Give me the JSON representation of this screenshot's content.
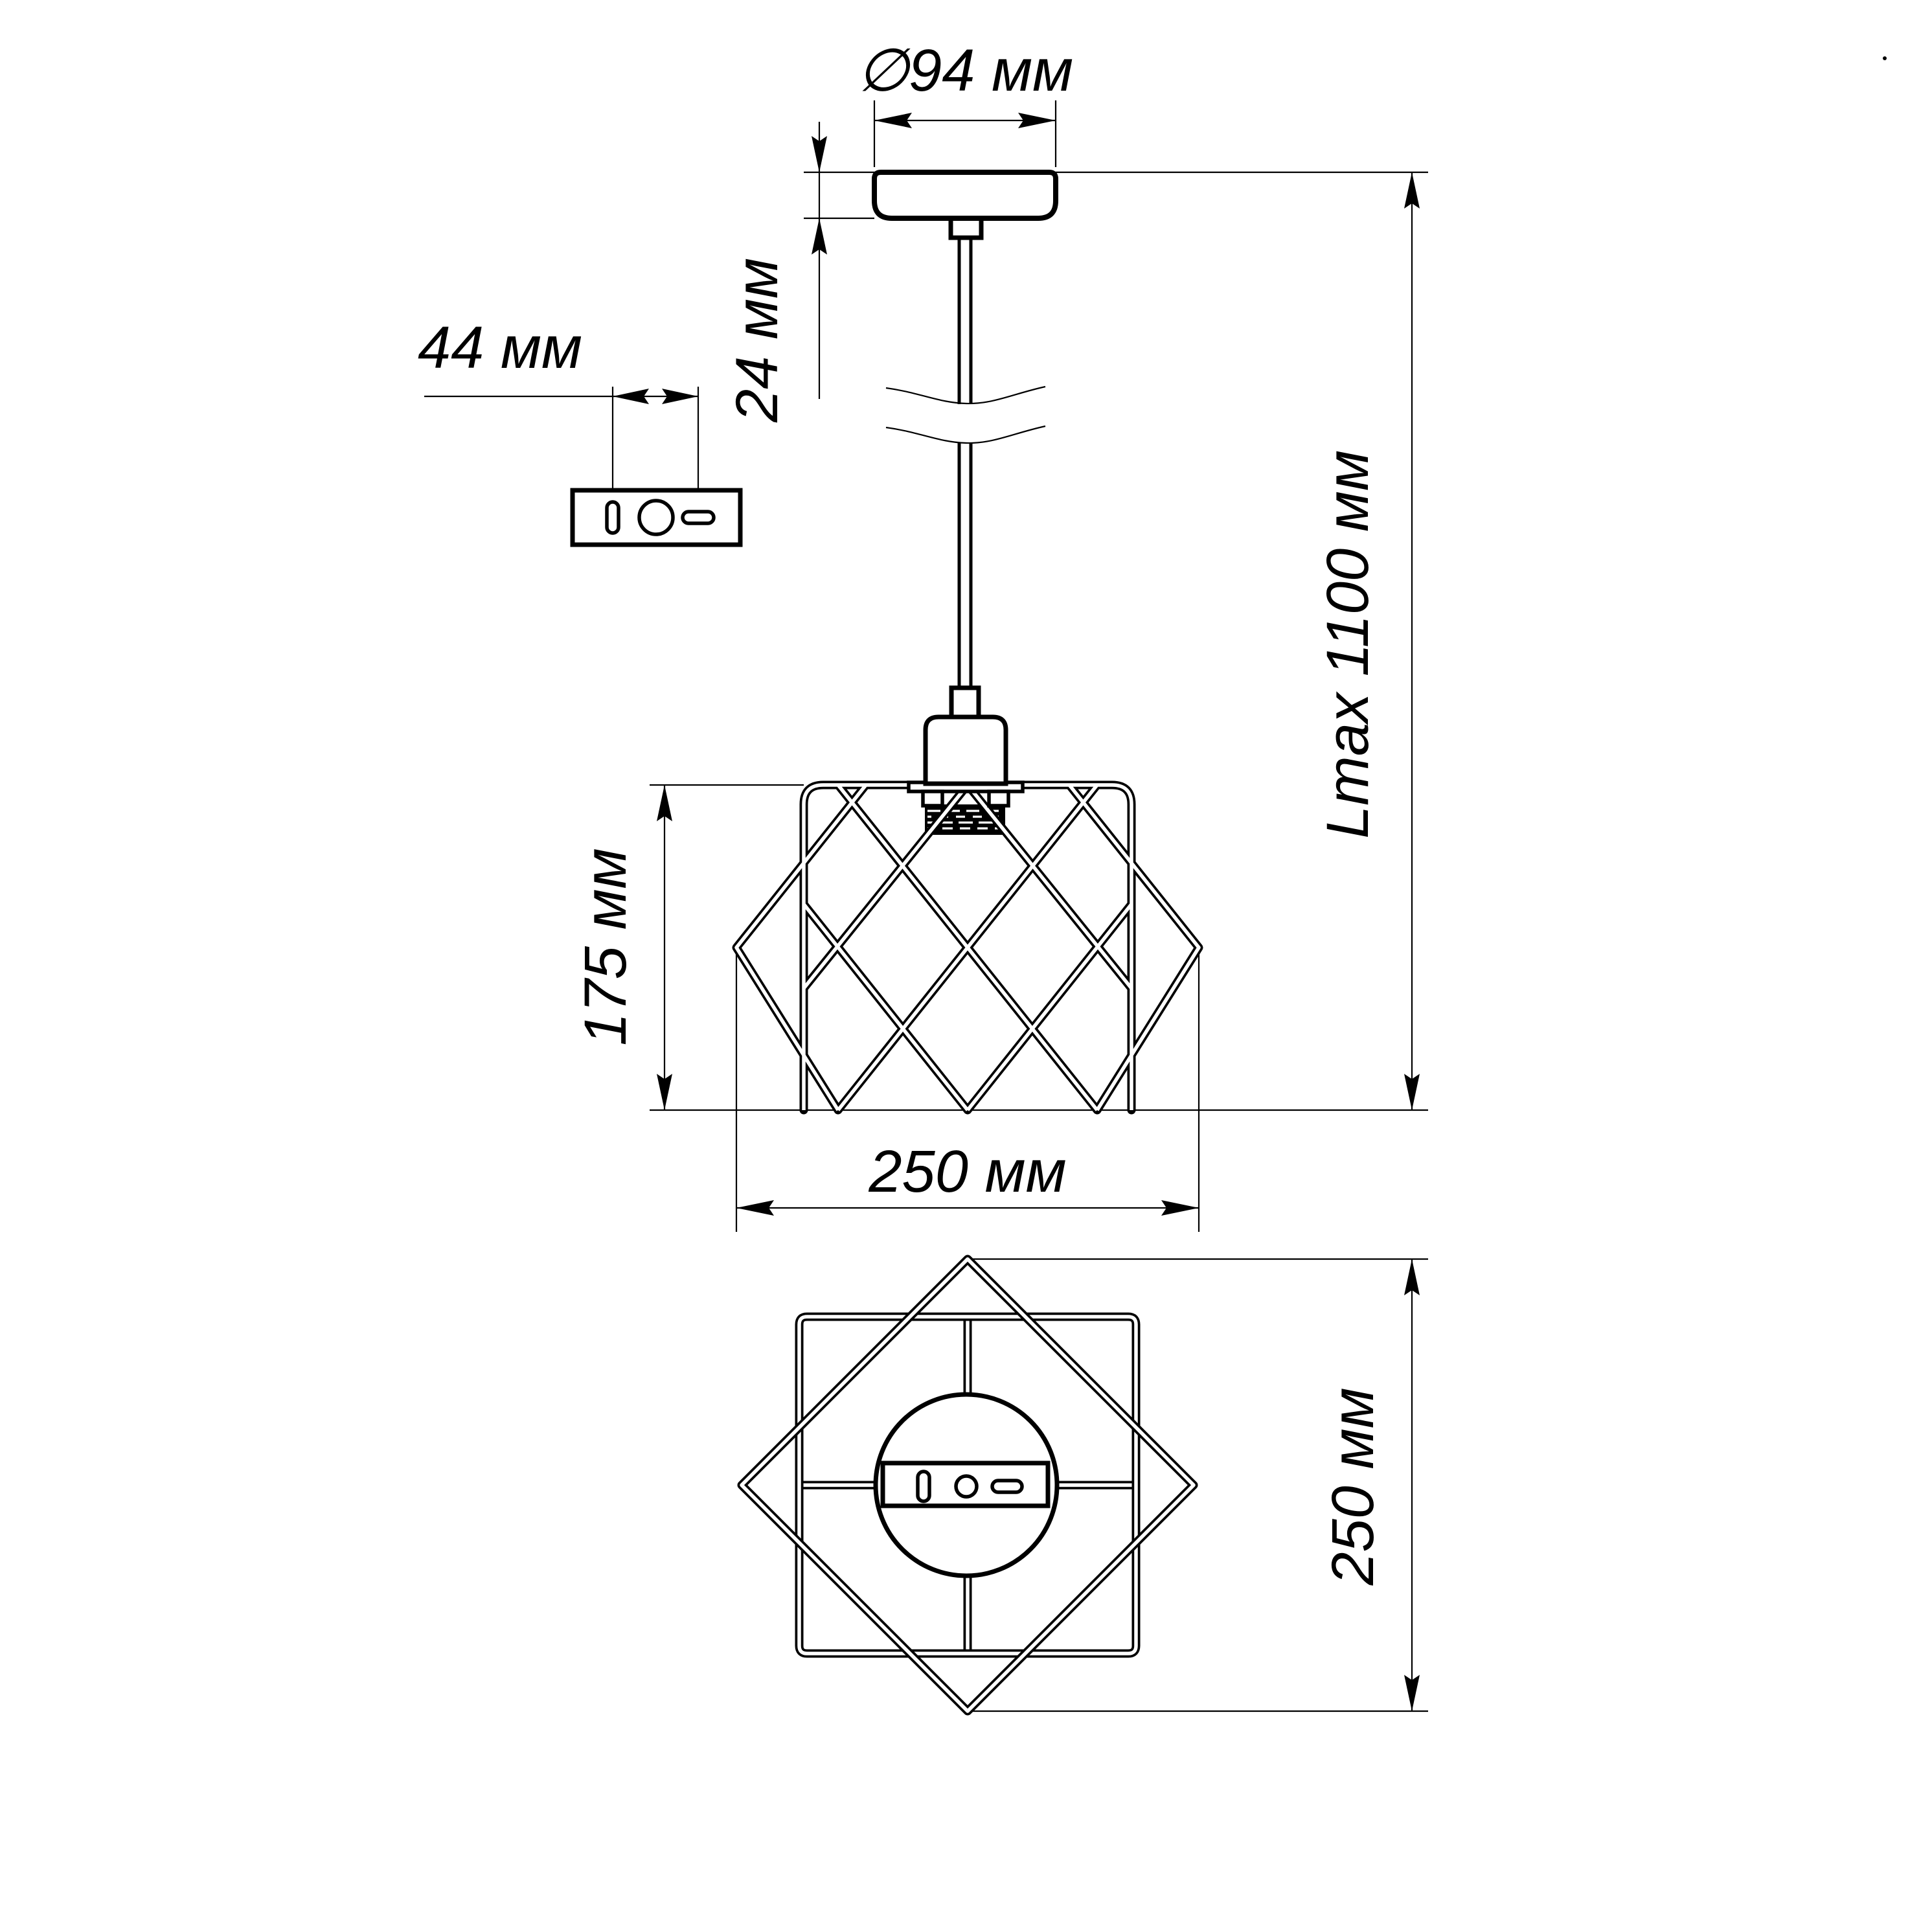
{
  "dimensions": {
    "canopy_diameter": "∅94 мм",
    "canopy_height": "24 мм",
    "bracket_hole_spacing": "44 мм",
    "max_suspension_length": "Lmax 1100 мм",
    "shade_height": "175 мм",
    "shade_width": "250 мм",
    "shade_plan_size": "250 мм"
  },
  "colors": {
    "line": "#000000",
    "background": "#ffffff"
  }
}
